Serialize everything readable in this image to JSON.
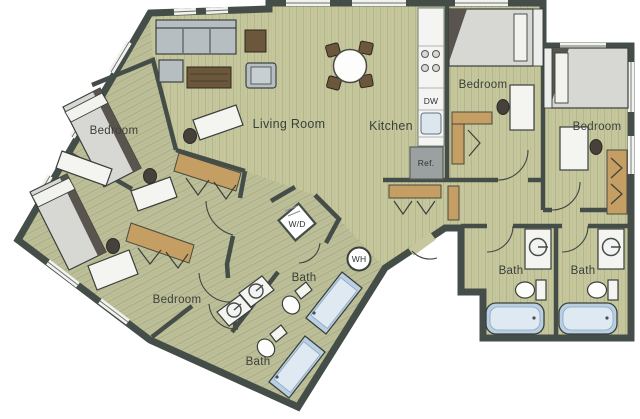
{
  "plan": {
    "rooms": {
      "bedroom1": {
        "label": "Bedroom"
      },
      "bedroom2": {
        "label": "Bedroom"
      },
      "bedroom3": {
        "label": "Bedroom"
      },
      "bedroom4": {
        "label": "Bedroom"
      },
      "living_room": {
        "label": "Living Room"
      },
      "kitchen": {
        "label": "Kitchen"
      },
      "bath1": {
        "label": "Bath"
      },
      "bath2": {
        "label": "Bath"
      },
      "bath3": {
        "label": "Bath"
      },
      "bath4": {
        "label": "Bath"
      }
    },
    "appliances": {
      "dishwasher": "DW",
      "refrigerator": "Ref.",
      "washer_dryer": "W/D",
      "water_heater": "WH"
    },
    "colors": {
      "wall": "#454d48",
      "floor_wood": "#c6c79d",
      "floor_wing": "#bcbf98",
      "closet_tan": "#c59e63",
      "tub_blue": "#b9cfe4",
      "background": "#ffffff"
    }
  }
}
